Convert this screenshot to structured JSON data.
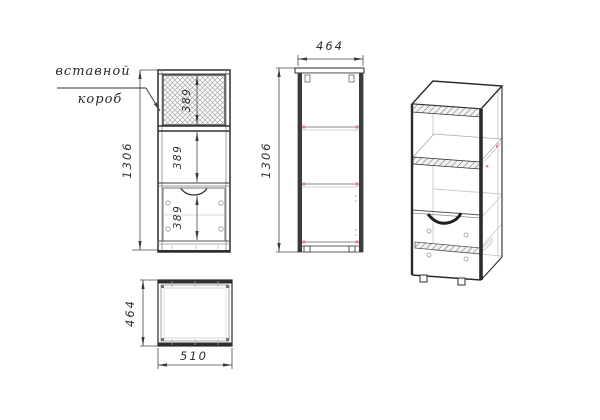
{
  "drawing": {
    "callout": {
      "line1": "вставной",
      "line2": "короб"
    },
    "front_view": {
      "total_height": "1306",
      "insert_box_height": "389",
      "middle_section_height": "389",
      "drawer_section_height": "389"
    },
    "side_view": {
      "depth": "464",
      "total_height": "1306"
    },
    "top_view": {
      "depth": "464",
      "width": "510"
    },
    "colors": {
      "background": "#ffffff",
      "line_dark": "#2e2e2e",
      "line_medium": "#555555",
      "line_light": "#c9c9c9",
      "hatch": "#a8a8a8",
      "marker_pink": "#e87bb0",
      "text": "#2f2f2f"
    }
  }
}
